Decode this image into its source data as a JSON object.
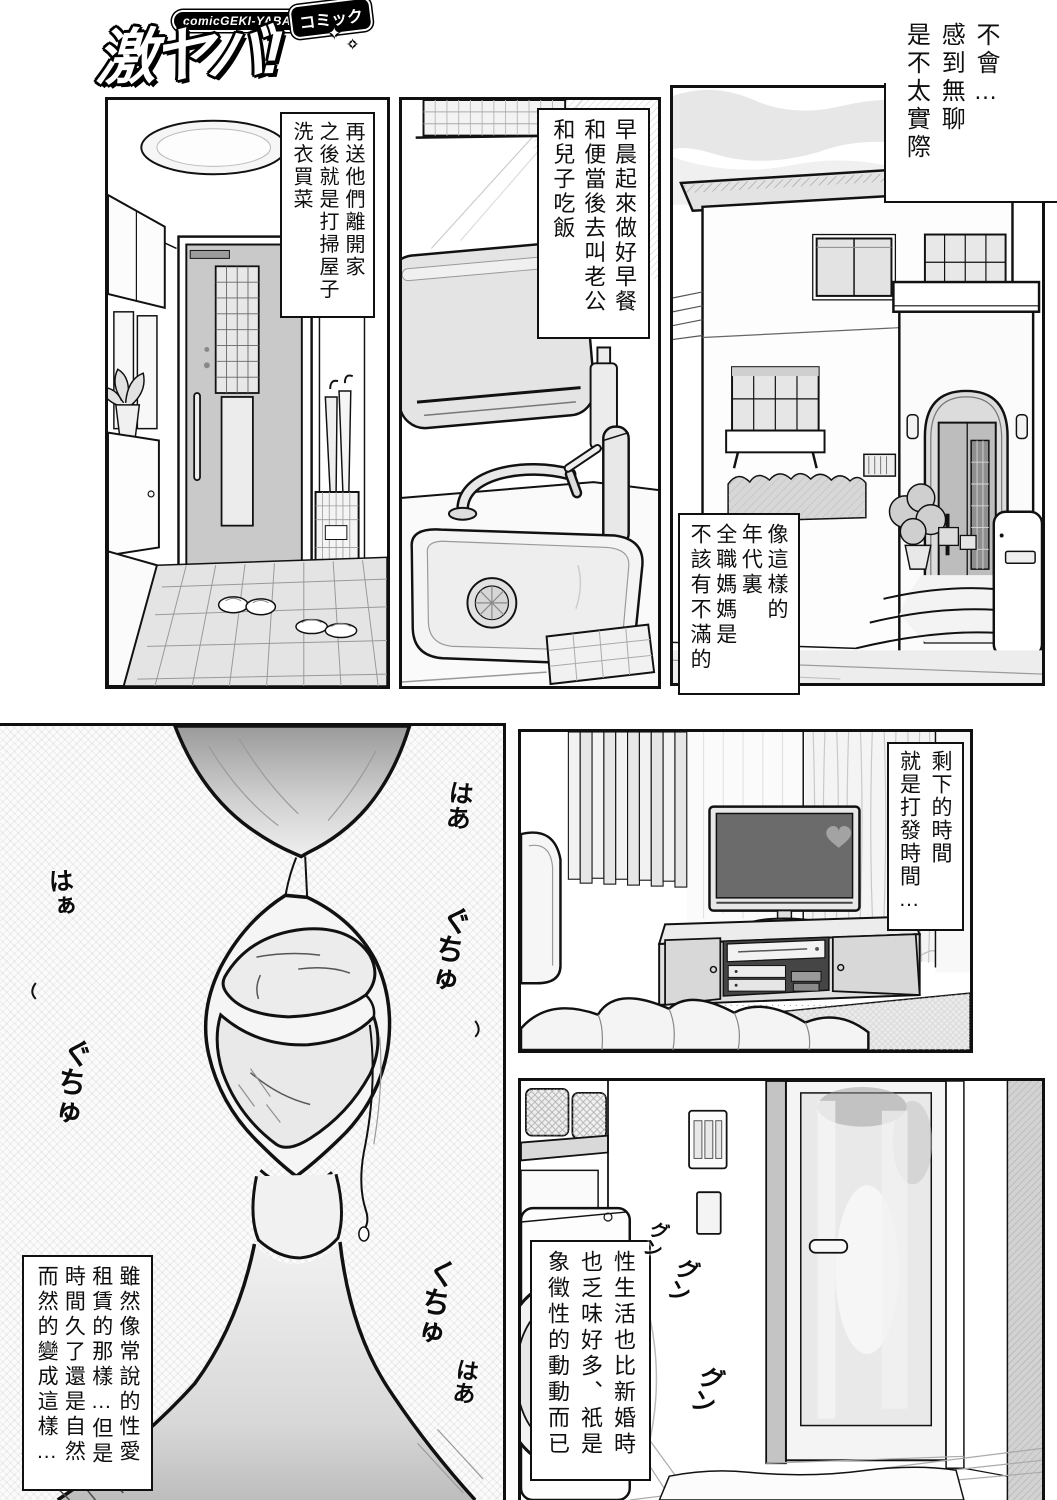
{
  "colors": {
    "ink": "#111111",
    "paper": "#ffffff",
    "tone_light": "#e9e9e9",
    "tone_mid": "#cfcfcf",
    "tone_dark": "#8f8f8f"
  },
  "logo": {
    "kicker": "comicGEKI-YABA",
    "badge": "コミック",
    "title": "激ヤバ!",
    "star": "✦"
  },
  "narration": {
    "intro": "不會…\n感到無聊\n是不太實際"
  },
  "captions": {
    "morning": "早晨起來做好早餐\n和便當後去叫老公\n和兒子吃飯",
    "sendoff": "再送他們離開家\n之後就是打掃屋子\n洗衣買菜",
    "era": "像這樣的\n年代裏\n全職媽媽是\n不該有不滿的",
    "leftover": "剩下的時間\n就是打發時間…",
    "sexlife": "性生活也比新婚時\n也乏味好多、祇是\n象徵性的動動而已",
    "rental": "雖然像常說的性愛\n租賃的那樣…但是\n時間久了還是自然\n而然的變成這樣…"
  },
  "sfx": {
    "breath1": "はあ",
    "breath2": "はぁ",
    "squish1": "ぐちゅ",
    "squish2": "ぐちゅ",
    "squish3": "くちゅ",
    "breath3": "はあ",
    "spin1": "グン",
    "spin2": "グン",
    "spin3": "グン"
  }
}
